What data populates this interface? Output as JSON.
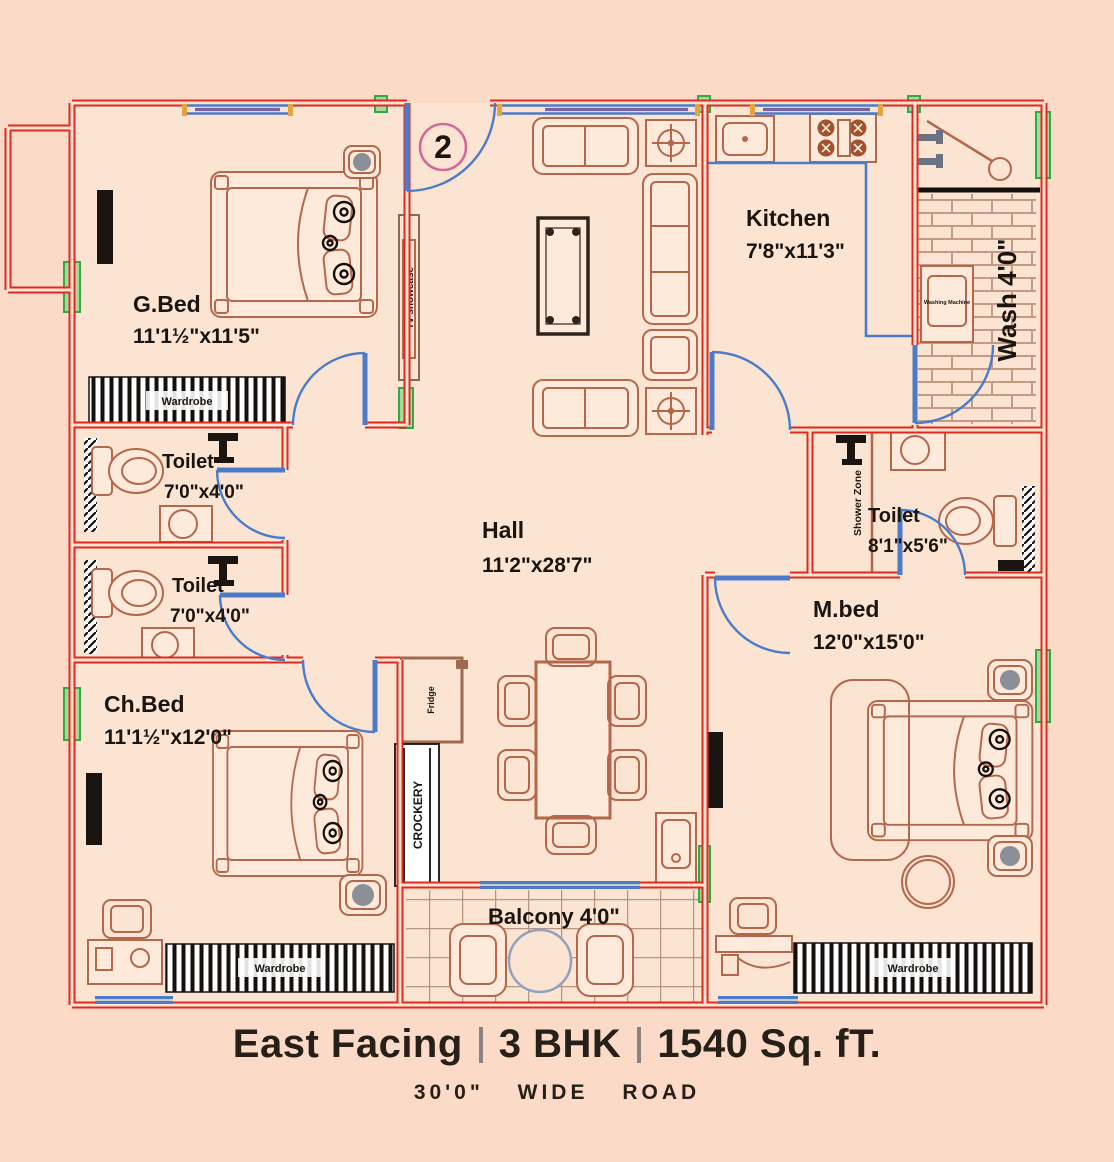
{
  "flat_number": "2",
  "rooms": {
    "gbed": {
      "name": "G.Bed",
      "dims": "11'1½\"x11'5\""
    },
    "kitchen": {
      "name": "Kitchen",
      "dims": "7'8\"x11'3\""
    },
    "hall": {
      "name": "Hall",
      "dims": "11'2\"x28'7\""
    },
    "chbed": {
      "name": "Ch.Bed",
      "dims": "11'1½\"x12'0\""
    },
    "mbed": {
      "name": "M.bed",
      "dims": "12'0\"x15'0\""
    },
    "toilet_top": {
      "name": "Toilet",
      "dims": "7'0\"x4'0\""
    },
    "toilet_bottom": {
      "name": "Toilet",
      "dims": "7'0\"x4'0\""
    },
    "toilet_master": {
      "name": "Toilet",
      "dims": "8'1\"x5'6\""
    },
    "wash": {
      "name": "Wash 4'0\""
    },
    "balcony": {
      "name": "Balcony 4'0\""
    }
  },
  "fixtures": {
    "wardrobe": "Wardrobe",
    "tv_unit": "Tv unit",
    "tv_showcase": "Tv showcase",
    "crockery": "CROCKERY",
    "fridge": "Fridge",
    "shower_zone": "Shower Zone",
    "washing_machine": "Washing Machine"
  },
  "footer": {
    "facing": "East Facing",
    "bhk": "3 BHK",
    "area": "1540 Sq. fT.",
    "road": "30'0\" WIDE ROAD"
  },
  "colors": {
    "wall": "#e02a1f",
    "door": "#4b7cc9",
    "window": "#2faa44",
    "furniture": "#b4674a",
    "floor": "#fce4d2",
    "background": "#fbdbc8",
    "text": "#1b1512"
  }
}
